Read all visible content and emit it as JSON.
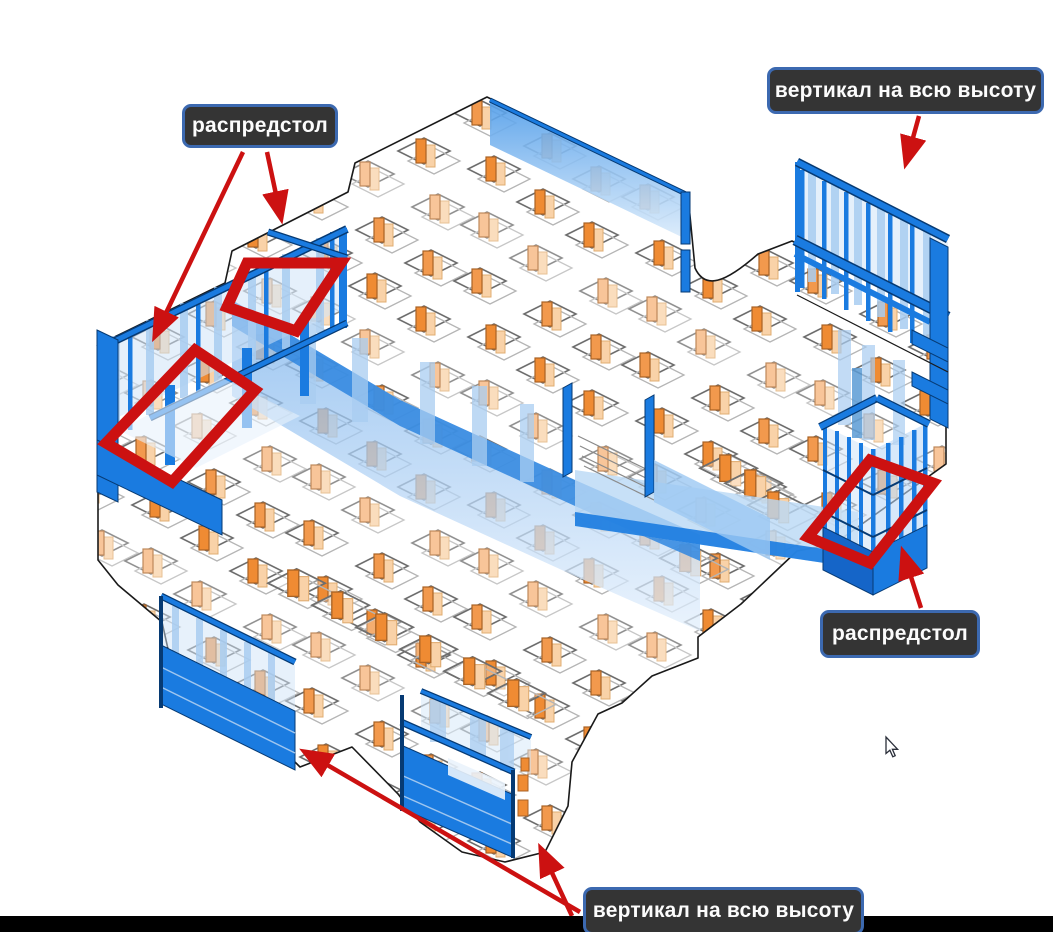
{
  "viewport": {
    "width": 1053,
    "height": 932,
    "background": "#ffffff"
  },
  "annotations": {
    "arrow_color": "#cc1111",
    "highlight_color": "#cc1111",
    "label_style": {
      "background": "#343434",
      "border": "#3c69b0",
      "text_color": "#fcfcfc"
    },
    "labels": [
      {
        "id": "raspredstol-left",
        "text": "распредстол"
      },
      {
        "id": "vertical-top",
        "text": "вертикал на всю высоту"
      },
      {
        "id": "raspredstol-right",
        "text": "распредстол"
      },
      {
        "id": "vertical-bottom",
        "text": "вертикал на всю высоту"
      }
    ]
  },
  "model": {
    "formwork_blue": "#1a7be0",
    "formwork_dark_edge": "#063a73",
    "panel_light_blue": "#cfe4f8",
    "post_light_blue": "#a9cdf1",
    "column_orange": "#f2994d",
    "column_light_orange": "#f9d2a8",
    "slab_outline": "#1a1a1a"
  },
  "cursor": {
    "x": 886,
    "y": 737
  },
  "bottom_bar": {
    "color": "#000000"
  }
}
